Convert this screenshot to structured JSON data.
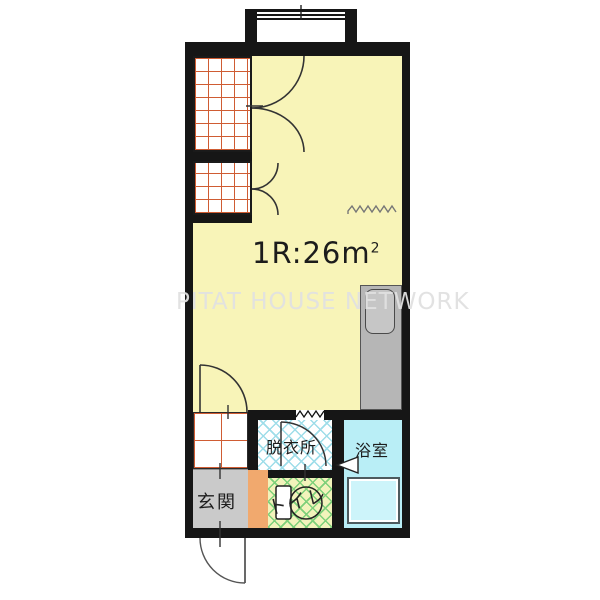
{
  "floorplan": {
    "size_label": "1R:26m",
    "size_superscript": "2",
    "watermark": "PITAT HOUSE NETWORK",
    "rooms": {
      "entrance": "玄関",
      "toilet": "トイレ",
      "dressing_room": "脱衣所",
      "bathroom": "浴室"
    },
    "colors": {
      "main_room_fill": "#f8f4b8",
      "wall": "#161616",
      "closet_grid_line": "#cf5c33",
      "entrance_fill": "#cacaca",
      "orange_strip_fill": "#f1a96e",
      "dressing_lattice": "#9edde9",
      "toilet_lattice": "#7ed07a",
      "toilet_fill": "#f2f3bb",
      "bathroom_fill": "#b9eef6",
      "bathtub_fill": "#cdf4fa",
      "kitchen_unit_fill": "#b6b6b6",
      "watermark_color": "#e0e0e0"
    }
  }
}
